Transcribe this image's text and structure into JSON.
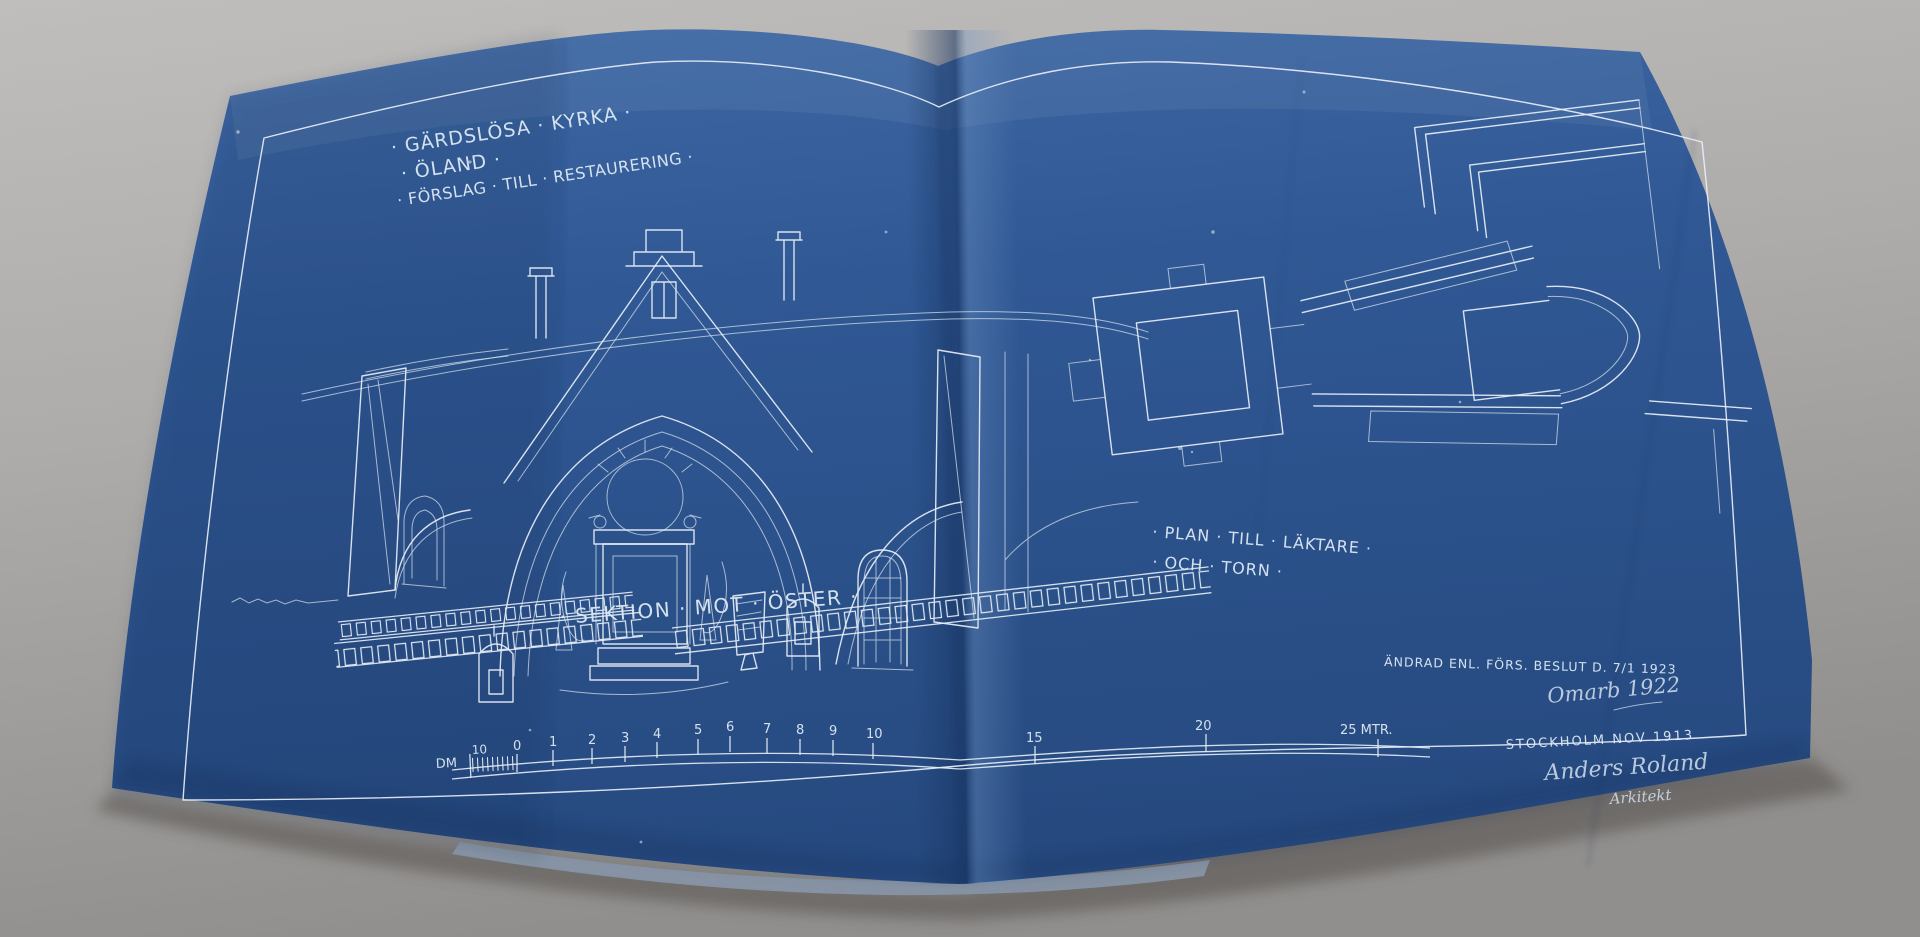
{
  "photo": {
    "background_color": "#b3b1af",
    "paper_color": "#2e5691",
    "line_color": "#e7eef7"
  },
  "titles": {
    "line1": "· GÄRDSLÖSA · KYRKA ·",
    "line2": "· ÖLAND ·",
    "line3": "· FÖRSLAG · TILL · RESTAURERING ·"
  },
  "captions": {
    "section": "· SEKTION · MOT · ÖSTER ·",
    "plan_line1": "· PLAN · TILL · LÄKTARE ·",
    "plan_line2": "· OCH · TORN ·"
  },
  "annotations": {
    "revision": "ÄNDRAD ENL. FÖRS. BESLUT D. 7/1 1923",
    "handwritten": "Omarb 1922",
    "place_date": "STOCKHOLM NOV 1913",
    "signature": "Anders Roland",
    "signature_title": "Arkitekt"
  },
  "scale_bar": {
    "unit": "DM",
    "pre_zero": "10",
    "ticks": [
      "0",
      "1",
      "2",
      "3",
      "4",
      "5",
      "6",
      "7",
      "8",
      "9",
      "10"
    ],
    "far_ticks": [
      "15",
      "20",
      "25 MTR."
    ]
  }
}
